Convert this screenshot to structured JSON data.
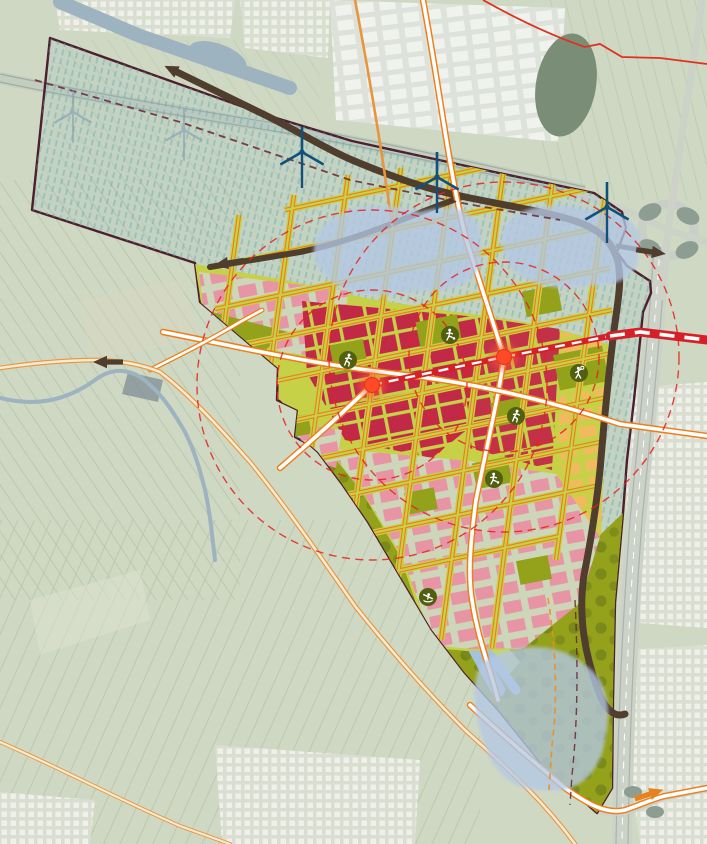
{
  "map": {
    "title": "urban-masterplan-overlay-on-aerial",
    "description": "Development masterplan for a polder area: gridded urban districts, transit line with two stations, lakes, linear park, ring road, wind turbines and sport icons, drawn over a pale aerial photo.",
    "palette": {
      "background_fields": "#cfd8c3",
      "field_lines": "#b7c5aa",
      "town_block": "#f2f3ee",
      "town_base": "#dadfd2",
      "water_existing": "#9db3c0",
      "lake_dark_existing": "#7a8d77",
      "lake_planned": "#b3c8e6",
      "canal_planned": "#a3c2de",
      "plan_tint": "#7fb2b8",
      "boundary": "#4d1f2d",
      "street_green": "#c6d147",
      "street_orange": "#ee7d1a",
      "road_white": "#ffffff",
      "block_red": "#c22947",
      "block_pink": "#e795a4",
      "block_pale": "#cdd6b8",
      "block_orange": "#f2ba5e",
      "park_olive": "#94a11b",
      "park_tree": "#76851a",
      "park_strip": "#c6d26e",
      "ring_road_brown": "#4f3d2d",
      "transit_red": "#d71f27",
      "station_core": "#ff4a28",
      "radius_dashed_red": "#e8211c",
      "turbine_planned": "#11507a",
      "turbine_existing": "#8aa2b2",
      "icon_circle": "#525f10",
      "icon_glyph": "#ffffff",
      "highway_gray": "#ccd2c8",
      "rural_red_line": "#e03020",
      "dashed_maroon": "#6b2430",
      "dashed_orange": "#f08c1e"
    },
    "features": {
      "plan_boundary": {
        "style": "dark maroon outline, teal hatched interior over polder"
      },
      "districts": [
        {
          "id": "urban-core-red-west"
        },
        {
          "id": "urban-core-red-east"
        },
        {
          "id": "residential-pink-northwest"
        },
        {
          "id": "residential-pink-south"
        },
        {
          "id": "mixed-orange-east-strip"
        },
        {
          "id": "north-polder-with-lakes"
        },
        {
          "id": "linear-park-with-canal"
        },
        {
          "id": "south-lake-park"
        }
      ],
      "lakes": [
        {
          "id": "lake-north-west"
        },
        {
          "id": "lake-north-east"
        },
        {
          "id": "lake-south"
        },
        {
          "id": "existing-dark-lake-northeast"
        }
      ],
      "transit_line": {
        "kind": "transit-line-white-dashes"
      },
      "stations": [
        {
          "id": "station-west",
          "x": 372,
          "y": 385,
          "walk_radii_px": [
            95,
            175
          ]
        },
        {
          "id": "station-east",
          "x": 504,
          "y": 357,
          "walk_radii_px": [
            95,
            175
          ]
        }
      ],
      "sport_icons": [
        {
          "sport": "running",
          "x": 348,
          "y": 360
        },
        {
          "sport": "soccer",
          "x": 450,
          "y": 335
        },
        {
          "sport": "tennis",
          "x": 579,
          "y": 373
        },
        {
          "sport": "running",
          "x": 516,
          "y": 416
        },
        {
          "sport": "soccer",
          "x": 494,
          "y": 479
        },
        {
          "sport": "rowing",
          "x": 428,
          "y": 597
        }
      ],
      "wind_turbines": {
        "planned": [
          {
            "x": 302,
            "y": 152
          },
          {
            "x": 437,
            "y": 177
          },
          {
            "x": 607,
            "y": 207
          }
        ],
        "existing": [
          {
            "x": 73,
            "y": 112
          },
          {
            "x": 184,
            "y": 130
          }
        ]
      },
      "flow_arrows": [
        {
          "x": 177,
          "y": 72,
          "angle": -154,
          "color": "brown"
        },
        {
          "x": 107,
          "y": 362,
          "angle": 180,
          "color": "brown"
        },
        {
          "x": 228,
          "y": 263,
          "angle": 171,
          "color": "brown"
        },
        {
          "x": 652,
          "y": 252,
          "angle": 8,
          "color": "brown"
        },
        {
          "x": 650,
          "y": 794,
          "angle": -18,
          "color": "orange"
        }
      ]
    }
  }
}
